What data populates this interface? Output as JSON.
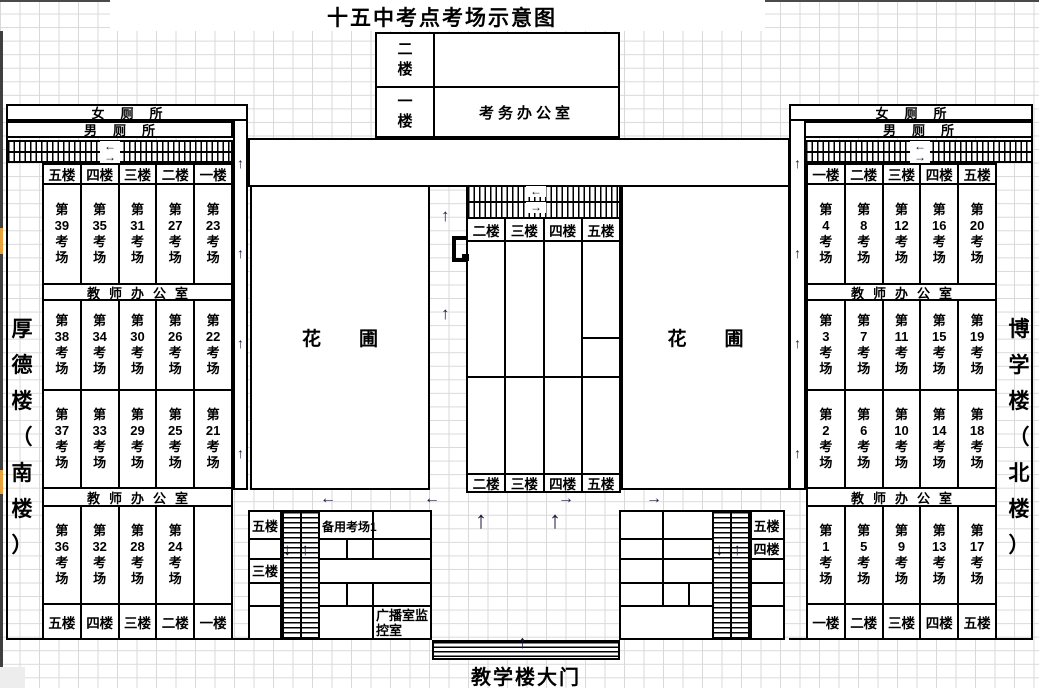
{
  "title": "十五中考点考场示意图",
  "admin_box": {
    "floor_2": "二楼",
    "floor_1": "一楼",
    "exam_office": "考务办公室"
  },
  "left_building": {
    "name": "厚德楼（南楼）",
    "women_toilet": "女厕所",
    "men_toilet": "男厕所",
    "teacher_office_1": "教师办公室",
    "teacher_office_2": "教师办公室",
    "floors_top": [
      "五楼",
      "四楼",
      "三楼",
      "二楼",
      "一楼"
    ],
    "floors_bottom": [
      "五楼",
      "四楼",
      "三楼",
      "二楼",
      "一楼"
    ],
    "room_rows": [
      [
        "第39考场",
        "第35考场",
        "第31考场",
        "第27考场",
        "第23考场"
      ],
      [
        "第38考场",
        "第34考场",
        "第30考场",
        "第26考场",
        "第22考场"
      ],
      [
        "第37考场",
        "第33考场",
        "第29考场",
        "第25考场",
        "第21考场"
      ],
      [
        "第36考场",
        "第32考场",
        "第28考场",
        "第24考场",
        ""
      ]
    ]
  },
  "right_building": {
    "name": "博学楼（北楼）",
    "women_toilet": "女厕所",
    "men_toilet": "男厕所",
    "teacher_office_1": "教师办公室",
    "teacher_office_2": "教师办公室",
    "floors_top": [
      "一楼",
      "二楼",
      "三楼",
      "四楼",
      "五楼"
    ],
    "floors_bottom": [
      "一楼",
      "二楼",
      "三楼",
      "四楼",
      "五楼"
    ],
    "room_rows": [
      [
        "第4考场",
        "第8考场",
        "第12考场",
        "第16考场",
        "第20考场"
      ],
      [
        "第3考场",
        "第7考场",
        "第11考场",
        "第15考场",
        "第19考场"
      ],
      [
        "第2考场",
        "第6考场",
        "第10考场",
        "第14考场",
        "第18考场"
      ],
      [
        "第1考场",
        "第5考场",
        "第9考场",
        "第13考场",
        "第17考场"
      ]
    ]
  },
  "center_block": {
    "floors_top": [
      "二楼",
      "三楼",
      "四楼",
      "五楼"
    ],
    "floors_bottom": [
      "二楼",
      "三楼",
      "四楼",
      "五楼"
    ]
  },
  "garden_left": "花圃",
  "garden_right": "花圃",
  "bottom_left_block": {
    "floor_row1": "五楼",
    "floor_row3": "三楼",
    "spare_room": "备用考场1",
    "broadcast_room": "广播室监控室"
  },
  "bottom_right_block": {
    "floor_row1": "五楼",
    "floor_row2": "四楼"
  },
  "gate": {
    "label": "教学楼大门"
  },
  "icons": {
    "arrow_up": "↑",
    "arrow_down": "↓",
    "arrow_left": "←",
    "arrow_right": "→"
  },
  "colors": {
    "accent_orange": "#E8A33D",
    "line": "#000000",
    "grid": "#D9D9D9"
  }
}
